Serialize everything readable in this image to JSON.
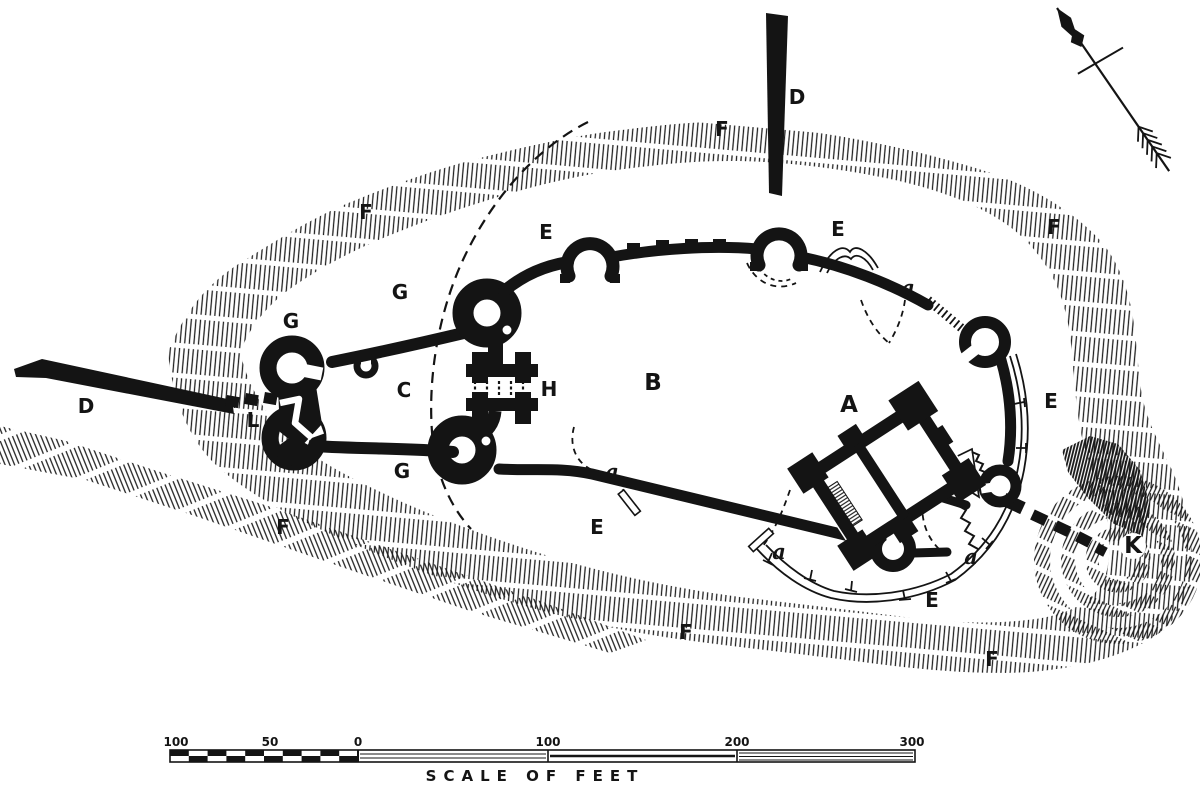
{
  "figure": {
    "type": "engraved castle ground plan",
    "colors": {
      "ink": "#141414",
      "paper": "#ffffff"
    }
  },
  "plan": {
    "labels": [
      {
        "id": "d-north",
        "text": "D"
      },
      {
        "id": "f-north",
        "text": "F"
      },
      {
        "id": "f-northwest",
        "text": "F"
      },
      {
        "id": "e-northwest",
        "text": "E"
      },
      {
        "id": "e-northeast",
        "text": "E"
      },
      {
        "id": "f-northeast",
        "text": "F"
      },
      {
        "id": "g-upper",
        "text": "G"
      },
      {
        "id": "g-west",
        "text": "G"
      },
      {
        "id": "a-northeast",
        "text": "a"
      },
      {
        "id": "c-outwork",
        "text": "C"
      },
      {
        "id": "h-gatehouse",
        "text": "H"
      },
      {
        "id": "b-bailey",
        "text": "B"
      },
      {
        "id": "a-keep",
        "text": "A"
      },
      {
        "id": "e-east",
        "text": "E"
      },
      {
        "id": "d-west",
        "text": "D"
      },
      {
        "id": "l-causeway",
        "text": "L"
      },
      {
        "id": "g-lower",
        "text": "G"
      },
      {
        "id": "a-south",
        "text": "a"
      },
      {
        "id": "e-south",
        "text": "E"
      },
      {
        "id": "f-southwest",
        "text": "F"
      },
      {
        "id": "a-southeast",
        "text": "a"
      },
      {
        "id": "a-east",
        "text": "a"
      },
      {
        "id": "k-mound",
        "text": "K"
      },
      {
        "id": "e-bottom",
        "text": "E"
      },
      {
        "id": "f-bottom",
        "text": "F"
      },
      {
        "id": "f-southeast",
        "text": "F"
      }
    ]
  },
  "scale_bar": {
    "ticks": [
      {
        "label": "100"
      },
      {
        "label": "50"
      },
      {
        "label": "0"
      },
      {
        "label": "100"
      },
      {
        "label": "200"
      },
      {
        "label": "300"
      }
    ],
    "caption": "SCALE OF FEET"
  }
}
